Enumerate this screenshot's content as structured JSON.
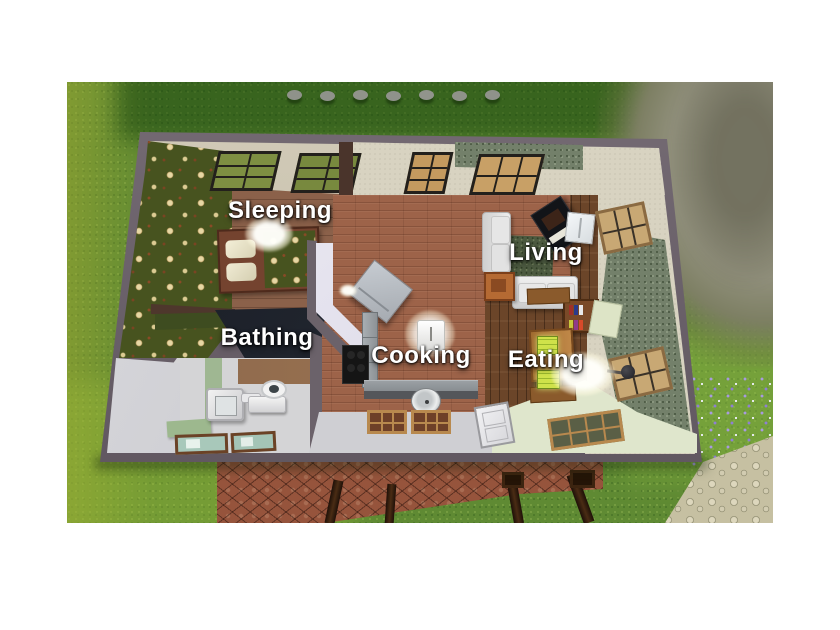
{
  "scene": {
    "description": "Top-down cutaway view of a small house with labeled functional rooms, surrounded by grass, a rock outcrop, flower patch, pebble path and cobblestone patio"
  },
  "rooms": [
    {
      "id": "sleeping",
      "label": "Sleeping"
    },
    {
      "id": "bathing",
      "label": "Bathing"
    },
    {
      "id": "cooking",
      "label": "Cooking"
    },
    {
      "id": "living",
      "label": "Living"
    },
    {
      "id": "eating",
      "label": "Eating"
    }
  ],
  "colors": {
    "outer_wall": "#6a6068",
    "grass": "#5f8a33",
    "label_text": "#ffffff",
    "kitchen_floor": "#9d6349",
    "floral_wallpaper": "#47531f",
    "speckle_wallpaper": "#73806a"
  }
}
